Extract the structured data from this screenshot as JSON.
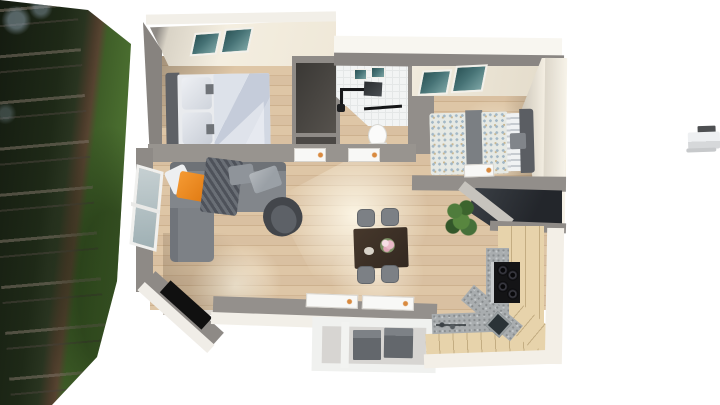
{
  "scene": {
    "label": "Top-down 3D architectural rendering of a small one-storey home interior, placed on a white page beside a rotated forest-and-lawn photograph strip",
    "backdrop_label": "Forest photograph with dark tree trunks and a green lawn",
    "distant_object_label": "Small white structure near the right edge",
    "rooms": {
      "bedroom1": {
        "label": "Main bedroom with double bed, wardrobe niche and two roof windows"
      },
      "bathroom": {
        "label": "Tiled bathroom with shower fittings, mirror and toilet"
      },
      "bedroom2": {
        "label": "Second bedroom with patterned single bed and roof window"
      },
      "living": {
        "label": "Living room with corner sofa, armchair, side window and sunlit floor"
      },
      "dining": {
        "label": "Dining area with dark table, four grey chairs and flowers"
      },
      "kitchen": {
        "label": "Angled kitchen with wooden cabinets, stone worktop, cooktop and sink"
      },
      "balcony": {
        "label": "Lower porch compartment with two grey storage bins"
      },
      "entry": {
        "label": "Angled entry corner with black doormat"
      },
      "closet": {
        "label": "Dark closet niche between bedroom and bathroom"
      },
      "stairwell": {
        "label": "Dark stair void opening beside the kitchen"
      }
    },
    "furniture": {
      "bed1": "Double bed with grey headboard and light blue duvet",
      "bed2": "Single bed with speckled duvet and grey runner",
      "sofa": "Grey corner sofa with chaise",
      "orange_pillow": "Orange accent pillow",
      "throw": "Dark knitted throw blanket",
      "armchair": "Dark grey swivel armchair",
      "dining_table": "Dark brown dining table",
      "dining_chairs": "Four grey dining chairs",
      "flowers": "Vase with pink flowers",
      "plant": "Green potted plant",
      "cooktop": "Black four-burner cooktop",
      "sink": "Corner kitchen sink",
      "toilet": "White toilet",
      "shower": "Black shower arm and head",
      "mirror": "Dark bathroom mirror",
      "doormat": "Black doormat",
      "storage_boxes": "Two grey storage bins",
      "window": "Living room side window",
      "skylights": "Teal roof windows",
      "doors": "Open white doors with orange handles"
    },
    "colors": {
      "background": "#ffffff",
      "wall_gray": "#95918d",
      "fascia_white": "#f2efe8",
      "ceiling_cream": "#f0e9da",
      "floor_wood": "#d5bb9b",
      "skylight_glass": "#477376",
      "grass_green": "#4a6c2f",
      "forest_dark": "#1c2617",
      "sofa_gray": "#82868b",
      "pillow_orange": "#ec8722",
      "armchair_dark": "#45484d",
      "table_brown": "#3a2e25",
      "chair_gray": "#7c8085",
      "cabinet_beige": "#e7d3ab",
      "countertop_gray": "#a9adaf",
      "cooktop_black": "#141416",
      "plant_green": "#3f6b35",
      "duvet_blue": "#ccd3df",
      "storage_box_gray": "#696d72"
    }
  }
}
